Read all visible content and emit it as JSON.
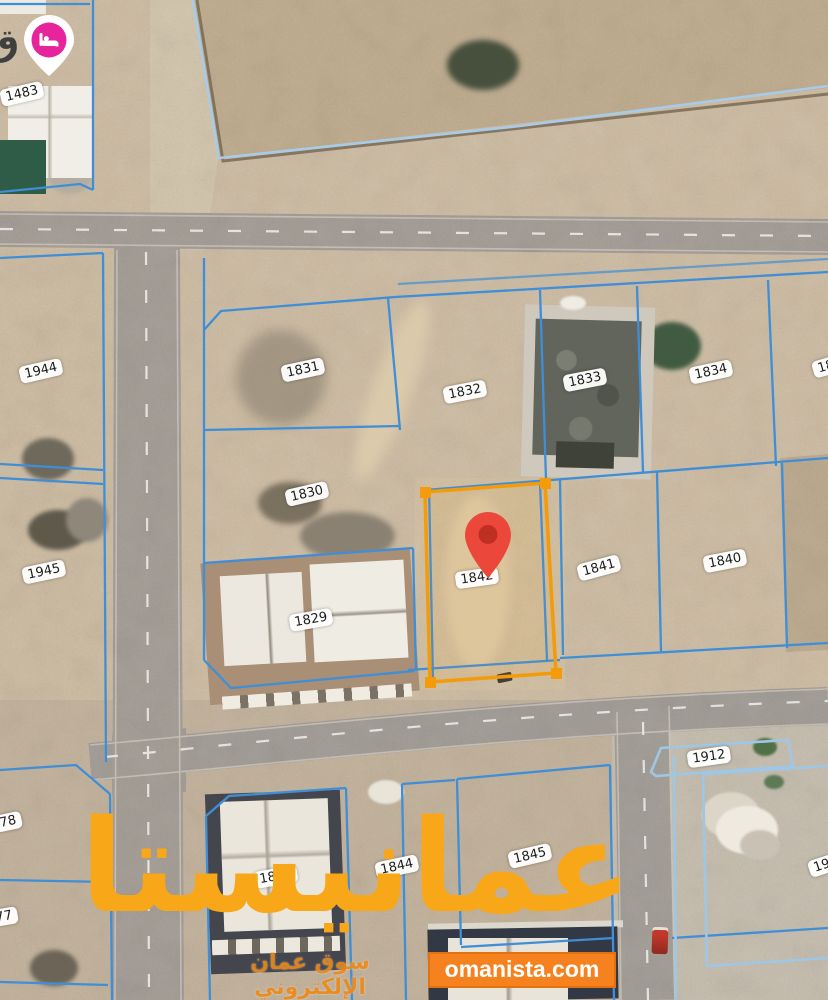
{
  "map": {
    "type": "satellite-cadastral-view",
    "selected_plot": {
      "number": "1842",
      "outline_color": "#F49B0C"
    },
    "location_pin_color": "#EB483B",
    "hotel_marker": {
      "icon": "bed-icon",
      "color": "#E6249B",
      "near_plot": "1483"
    },
    "plot_line_color": "#3F8ED6",
    "light_boundary_color": "#9EC7E6",
    "partial_place_label": "ق"
  },
  "plot_labels": [
    {
      "text": "1483",
      "x": 22,
      "y": 94,
      "rot": -13
    },
    {
      "text": "1944",
      "x": 41,
      "y": 371,
      "rot": -13
    },
    {
      "text": "1945",
      "x": 44,
      "y": 572,
      "rot": -12
    },
    {
      "text": "1831",
      "x": 303,
      "y": 370,
      "rot": -12
    },
    {
      "text": "1832",
      "x": 465,
      "y": 392,
      "rot": -11
    },
    {
      "text": "1833",
      "x": 585,
      "y": 380,
      "rot": -11
    },
    {
      "text": "1834",
      "x": 711,
      "y": 372,
      "rot": -12
    },
    {
      "text": "18",
      "x": 826,
      "y": 367,
      "rot": -16
    },
    {
      "text": "1830",
      "x": 307,
      "y": 494,
      "rot": -13
    },
    {
      "text": "1829",
      "x": 311,
      "y": 620,
      "rot": -10
    },
    {
      "text": "1842",
      "x": 477,
      "y": 578,
      "rot": -8
    },
    {
      "text": "1841",
      "x": 599,
      "y": 568,
      "rot": -15
    },
    {
      "text": "1840",
      "x": 725,
      "y": 561,
      "rot": -11
    },
    {
      "text": "1912",
      "x": 709,
      "y": 757,
      "rot": -8
    },
    {
      "text": "78",
      "x": 8,
      "y": 822,
      "rot": -12
    },
    {
      "text": "77",
      "x": 4,
      "y": 917,
      "rot": -10
    },
    {
      "text": "1843",
      "x": 276,
      "y": 877,
      "rot": -10
    },
    {
      "text": "1844",
      "x": 397,
      "y": 867,
      "rot": -12
    },
    {
      "text": "1845",
      "x": 530,
      "y": 856,
      "rot": -13
    },
    {
      "text": "19",
      "x": 822,
      "y": 866,
      "rot": -18
    }
  ],
  "watermark": {
    "brand_arabic": "عمانيستا",
    "tagline_arabic": "سوق عمان الإلكتروني",
    "website": "omanista.com",
    "brand_color": "#F7A717",
    "site_box_color": "#F6821F"
  }
}
